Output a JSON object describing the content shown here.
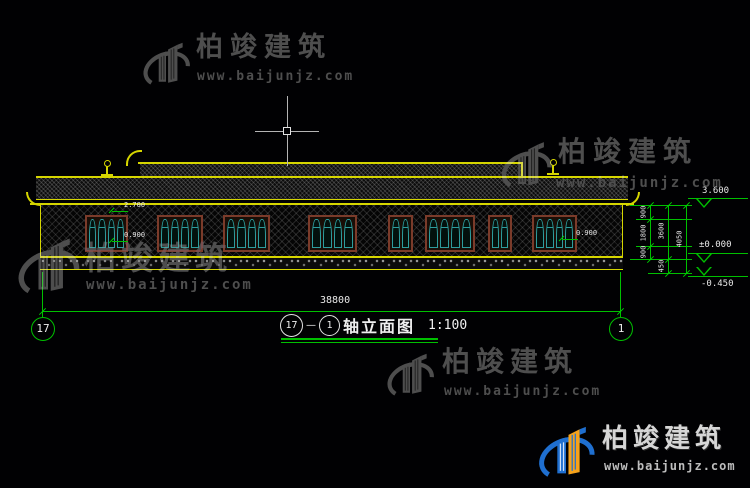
{
  "watermark": {
    "brand": "柏竣建筑",
    "url": "www.baijunjz.com",
    "gray_color": "#4e4e4e",
    "logo_blue": "#1f6fd0",
    "logo_orange": "#f5a21b"
  },
  "drawing": {
    "title": {
      "axis_start": "17",
      "dash": "—",
      "axis_end": "1",
      "name": "轴立面图",
      "scale": "1:100"
    },
    "axis_bubbles": {
      "left": "17",
      "right": "1"
    },
    "dimensions": {
      "overall_width": "38800",
      "right_chain": [
        "900",
        "1800",
        "900"
      ],
      "right_total": "3600",
      "right_sub": "450",
      "right_overall": "4050"
    },
    "elevations": {
      "eave": "3.600",
      "ground": "±0.000",
      "below_ground": "-0.450",
      "window_head": "2.700",
      "window_sill_left": "0.900",
      "window_sill_right": "0.900"
    },
    "colors": {
      "outline_yellow": "#d6d600",
      "dimension_green": "#00c000",
      "window_teal": "#2d9d9d",
      "window_frame_brown": "#7b3b2a",
      "text_white": "#e9e9e9"
    }
  }
}
